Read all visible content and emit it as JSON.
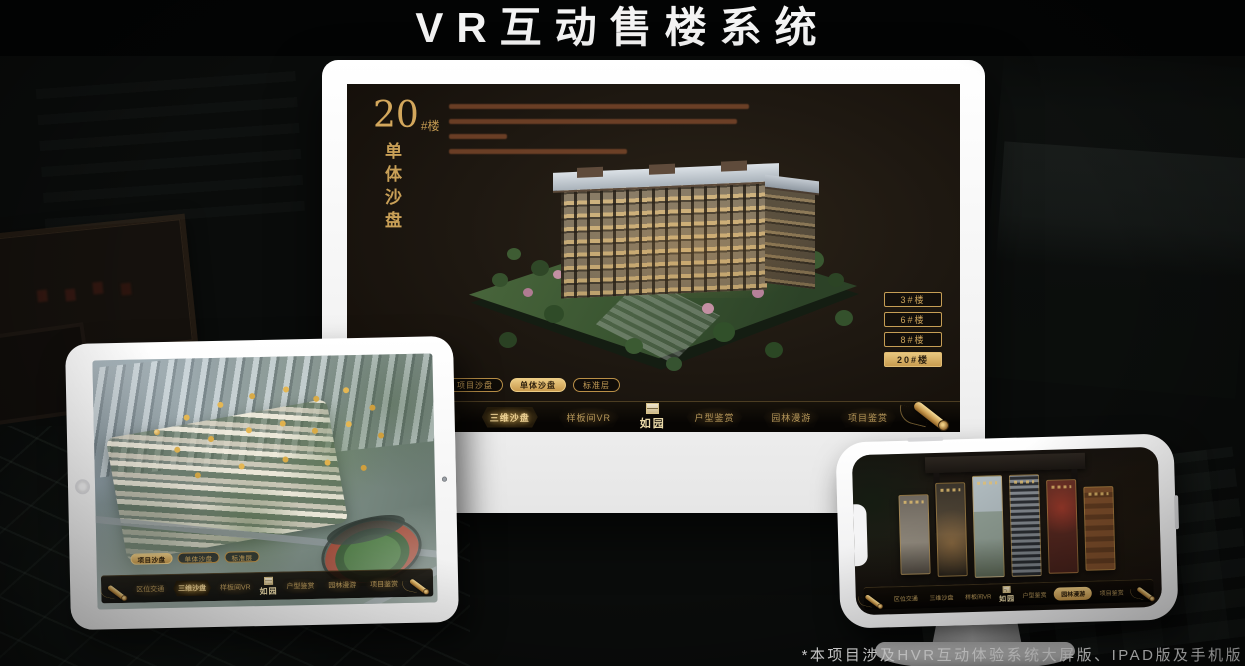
{
  "page": {
    "title": "VR互动售楼系统",
    "footnote": "*本项目涉及HVR互动体验系统大屏版、IPAD版及手机版"
  },
  "colors": {
    "gold": "#cfa55f",
    "screen_bg": "#1d1610",
    "device_white": "#f5f5f5"
  },
  "monitor": {
    "headline": {
      "number": "20",
      "suffix": "#楼",
      "subtitle": "单体沙盘"
    },
    "tabs": [
      {
        "label": "项目沙盘"
      },
      {
        "label": "单体沙盘"
      },
      {
        "label": "标准层"
      }
    ],
    "active_tab": "单体沙盘",
    "floor_buttons": [
      {
        "label": "3#楼"
      },
      {
        "label": "6#楼"
      },
      {
        "label": "8#楼"
      },
      {
        "label": "20#楼"
      }
    ],
    "active_floor": "20#楼",
    "nav": {
      "items": [
        {
          "label": "区位交通"
        },
        {
          "label": "三维沙盘"
        },
        {
          "label": "样板间VR"
        },
        {
          "label": "户型鉴赏"
        },
        {
          "label": "园林漫游"
        },
        {
          "label": "项目鉴赏"
        }
      ],
      "logo": "如园",
      "active": "三维沙盘"
    }
  },
  "tablet": {
    "tabs": [
      {
        "label": "项目沙盘"
      },
      {
        "label": "单体沙盘"
      },
      {
        "label": "标准层"
      }
    ],
    "active_tab": "项目沙盘",
    "nav": {
      "items": [
        {
          "label": "区位交通"
        },
        {
          "label": "三维沙盘"
        },
        {
          "label": "样板间VR"
        },
        {
          "label": "户型鉴赏"
        },
        {
          "label": "园林漫游"
        },
        {
          "label": "项目鉴赏"
        }
      ],
      "logo": "如园",
      "active": "三维沙盘"
    }
  },
  "phone": {
    "nav": {
      "items": [
        {
          "label": "区位交通"
        },
        {
          "label": "三维沙盘"
        },
        {
          "label": "样板间VR"
        },
        {
          "label": "户型鉴赏"
        },
        {
          "label": "园林漫游"
        },
        {
          "label": "项目鉴赏"
        }
      ],
      "logo": "如园",
      "active": "园林漫游"
    }
  }
}
